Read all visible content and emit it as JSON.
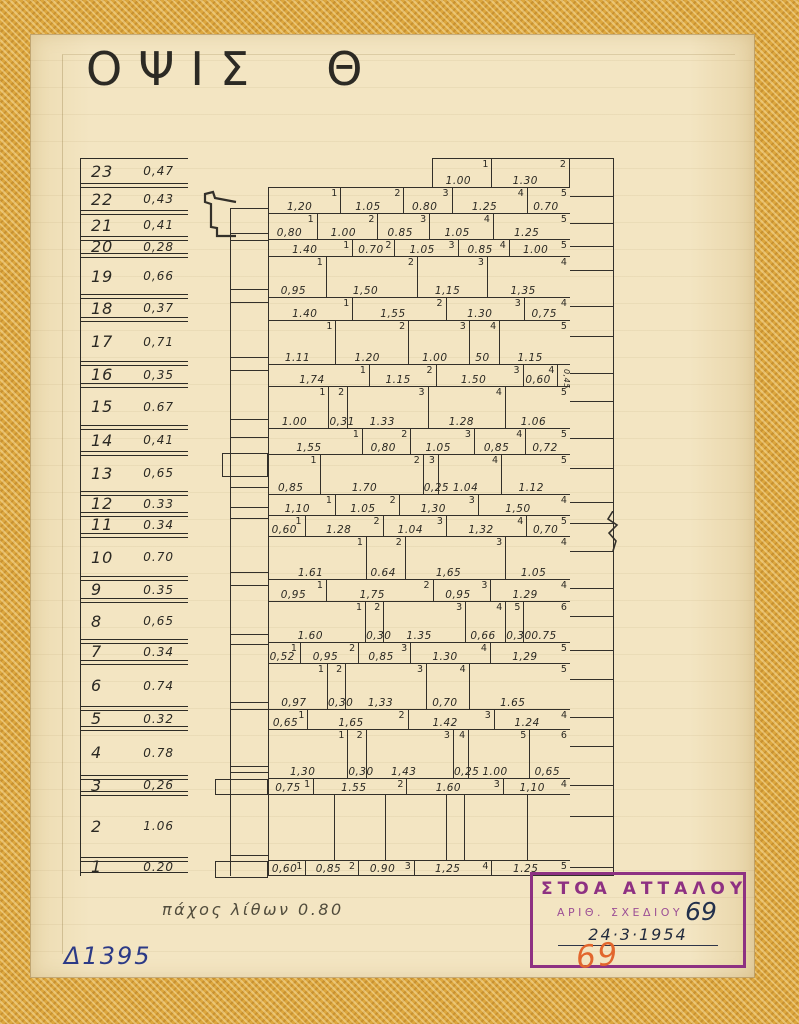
{
  "title": "ΟΨΙΣ  Θ",
  "notes": {
    "thickness": "πάχος λίθων 0.80",
    "ref": "Δ1395"
  },
  "stamp": {
    "line1": "ΣΤΟΑ ΑΤΤΑΛΟΥ",
    "line2": "ΑΡΙΘ. ΣΧΕΔΙΟΥ",
    "number": "69",
    "date": "24·3·1954",
    "number_pencil": "69"
  },
  "colors": {
    "ink": "#33302a",
    "paper": "#f3e5c2",
    "tape": "#dda73e",
    "stamp_purple": "#8e3182",
    "pencil_orange": "#e2662d",
    "ref_blue": "#2c3a86"
  },
  "courses": [
    {
      "n": "23",
      "h": "0,47",
      "offset": 2.75,
      "blocks": [
        {
          "n": "1",
          "v": "1.00",
          "w": 1.0
        },
        {
          "n": "2",
          "v": "1.30",
          "w": 1.3
        }
      ]
    },
    {
      "n": "22",
      "h": "0,43",
      "blocks": [
        {
          "n": "1",
          "v": "1,20",
          "w": 1.2
        },
        {
          "n": "2",
          "v": "1.05",
          "w": 1.05
        },
        {
          "n": "3",
          "v": "0.80",
          "w": 0.8
        },
        {
          "n": "4",
          "v": "1.25",
          "w": 1.25
        },
        {
          "n": "5",
          "v": "0.70",
          "w": 0.7
        }
      ]
    },
    {
      "n": "21",
      "h": "0,41",
      "blocks": [
        {
          "n": "1",
          "v": "0,80",
          "w": 0.8
        },
        {
          "n": "2",
          "v": "1.00",
          "w": 1.0
        },
        {
          "n": "3",
          "v": "0.85",
          "w": 0.85
        },
        {
          "n": "4",
          "v": "1.05",
          "w": 1.05
        },
        {
          "n": "5",
          "v": "1.25",
          "w": 1.25
        }
      ]
    },
    {
      "n": "20",
      "h": "0,28",
      "blocks": [
        {
          "n": "1",
          "v": "1.40",
          "w": 1.4
        },
        {
          "n": "2",
          "v": "0.70",
          "w": 0.7
        },
        {
          "n": "3",
          "v": "1.05",
          "w": 1.05
        },
        {
          "n": "4",
          "v": "0.85",
          "w": 0.85
        },
        {
          "n": "5",
          "v": "1.00",
          "w": 1.0
        }
      ]
    },
    {
      "n": "19",
      "h": "0,66",
      "blocks": [
        {
          "n": "1",
          "v": "0,95",
          "w": 0.95
        },
        {
          "n": "2",
          "v": "1,50",
          "w": 1.5
        },
        {
          "n": "3",
          "v": "1,15",
          "w": 1.15
        },
        {
          "n": "4",
          "v": "1,35",
          "w": 1.35
        }
      ]
    },
    {
      "n": "18",
      "h": "0,37",
      "blocks": [
        {
          "n": "1",
          "v": "1.40",
          "w": 1.4
        },
        {
          "n": "2",
          "v": "1,55",
          "w": 1.55
        },
        {
          "n": "3",
          "v": "1.30",
          "w": 1.3
        },
        {
          "n": "4",
          "v": "0,75",
          "w": 0.75
        }
      ]
    },
    {
      "n": "17",
      "h": "0,71",
      "blocks": [
        {
          "n": "1",
          "v": "1.11",
          "w": 1.11
        },
        {
          "n": "2",
          "v": "1.20",
          "w": 1.2
        },
        {
          "n": "3",
          "v": "1.00",
          "w": 1.0
        },
        {
          "n": "4",
          "v": "50",
          "w": 0.5
        },
        {
          "n": "5",
          "v": "1.15",
          "w": 1.15
        }
      ]
    },
    {
      "n": "16",
      "h": "0,35",
      "blocks": [
        {
          "n": "1",
          "v": "1,74",
          "w": 1.74
        },
        {
          "n": "2",
          "v": "1.15",
          "w": 1.15
        },
        {
          "n": "3",
          "v": "1.50",
          "w": 1.5
        },
        {
          "n": "4",
          "v": "0,60",
          "w": 0.6
        },
        {
          "n": "",
          "v": "0,45",
          "w": 0.2,
          "vertical": true
        }
      ]
    },
    {
      "n": "15",
      "h": "0.67",
      "blocks": [
        {
          "n": "1",
          "v": "1.00",
          "w": 1.0
        },
        {
          "n": "2",
          "v": "0,31",
          "w": 0.31
        },
        {
          "n": "3",
          "v": "1.33",
          "w": 1.33
        },
        {
          "n": "4",
          "v": "1.28",
          "w": 1.28
        },
        {
          "n": "5",
          "v": "1.06",
          "w": 1.06
        }
      ]
    },
    {
      "n": "14",
      "h": "0,41",
      "blocks": [
        {
          "n": "1",
          "v": "1,55",
          "w": 1.55
        },
        {
          "n": "2",
          "v": "0,80",
          "w": 0.8
        },
        {
          "n": "3",
          "v": "1.05",
          "w": 1.05
        },
        {
          "n": "4",
          "v": "0,85",
          "w": 0.85
        },
        {
          "n": "5",
          "v": "0,72",
          "w": 0.72
        }
      ]
    },
    {
      "n": "13",
      "h": "0,65",
      "blocks": [
        {
          "n": "1",
          "v": "0,85",
          "w": 0.85
        },
        {
          "n": "2",
          "v": "1.70",
          "w": 1.7
        },
        {
          "n": "3",
          "v": "0,25",
          "w": 0.25
        },
        {
          "n": "4",
          "v": "1.04",
          "w": 1.04
        },
        {
          "n": "5",
          "v": "1.12",
          "w": 1.12
        }
      ]
    },
    {
      "n": "12",
      "h": "0.33",
      "blocks": [
        {
          "n": "1",
          "v": "1,10",
          "w": 1.1
        },
        {
          "n": "2",
          "v": "1.05",
          "w": 1.05
        },
        {
          "n": "3",
          "v": "1,30",
          "w": 1.3
        },
        {
          "n": "4",
          "v": "1,50",
          "w": 1.5
        }
      ]
    },
    {
      "n": "11",
      "h": "0.34",
      "blocks": [
        {
          "n": "1",
          "v": "0,60",
          "w": 0.6
        },
        {
          "n": "2",
          "v": "1.28",
          "w": 1.28
        },
        {
          "n": "3",
          "v": "1.04",
          "w": 1.04
        },
        {
          "n": "4",
          "v": "1,32",
          "w": 1.32
        },
        {
          "n": "5",
          "v": "0,70",
          "w": 0.7
        }
      ]
    },
    {
      "n": "10",
      "h": "0.70",
      "blocks": [
        {
          "n": "1",
          "v": "1.61",
          "w": 1.61
        },
        {
          "n": "2",
          "v": "0.64",
          "w": 0.64
        },
        {
          "n": "3",
          "v": "1,65",
          "w": 1.65
        },
        {
          "n": "4",
          "v": "1.05",
          "w": 1.05
        }
      ]
    },
    {
      "n": "9",
      "h": "0.35",
      "blocks": [
        {
          "n": "1",
          "v": "0,95",
          "w": 0.95
        },
        {
          "n": "2",
          "v": "1,75",
          "w": 1.75
        },
        {
          "n": "3",
          "v": "0,95",
          "w": 0.95
        },
        {
          "n": "4",
          "v": "1.29",
          "w": 1.29
        }
      ]
    },
    {
      "n": "8",
      "h": "0,65",
      "blocks": [
        {
          "n": "1",
          "v": "1.60",
          "w": 1.6
        },
        {
          "n": "2",
          "v": "0,30",
          "w": 0.3
        },
        {
          "n": "3",
          "v": "1.35",
          "w": 1.35
        },
        {
          "n": "4",
          "v": "0,66",
          "w": 0.66
        },
        {
          "n": "5",
          "v": "0,30",
          "w": 0.3
        },
        {
          "n": "6",
          "v": "0.75",
          "w": 0.75
        }
      ]
    },
    {
      "n": "7",
      "h": "0.34",
      "blocks": [
        {
          "n": "1",
          "v": "0,52",
          "w": 0.52
        },
        {
          "n": "2",
          "v": "0,95",
          "w": 0.95
        },
        {
          "n": "3",
          "v": "0,85",
          "w": 0.85
        },
        {
          "n": "4",
          "v": "1.30",
          "w": 1.3
        },
        {
          "n": "5",
          "v": "1,29",
          "w": 1.29
        }
      ]
    },
    {
      "n": "6",
      "h": "0.74",
      "blocks": [
        {
          "n": "1",
          "v": "0,97",
          "w": 0.97
        },
        {
          "n": "2",
          "v": "0,30",
          "w": 0.3
        },
        {
          "n": "3",
          "v": "1,33",
          "w": 1.33
        },
        {
          "n": "4",
          "v": "0,70",
          "w": 0.7
        },
        {
          "n": "5",
          "v": "1.65",
          "w": 1.65
        }
      ]
    },
    {
      "n": "5",
      "h": "0.32",
      "blocks": [
        {
          "n": "1",
          "v": "0,65",
          "w": 0.65
        },
        {
          "n": "2",
          "v": "1,65",
          "w": 1.65
        },
        {
          "n": "3",
          "v": "1.42",
          "w": 1.42
        },
        {
          "n": "4",
          "v": "1.24",
          "w": 1.24
        }
      ]
    },
    {
      "n": "4",
      "h": "0.78",
      "blocks": [
        {
          "n": "1",
          "v": "1,30",
          "w": 1.3
        },
        {
          "n": "2",
          "v": "0,30",
          "w": 0.3
        },
        {
          "n": "3",
          "v": "1,43",
          "w": 1.43
        },
        {
          "n": "4",
          "v": "0,25",
          "w": 0.25
        },
        {
          "n": "5",
          "v": "1.00",
          "w": 1.0
        },
        {
          "n": "6",
          "v": "0,65",
          "w": 0.65
        }
      ]
    },
    {
      "n": "3",
      "h": "0,26",
      "blocks": [
        {
          "n": "1",
          "v": "0,75",
          "w": 0.75
        },
        {
          "n": "2",
          "v": "1.55",
          "w": 1.55
        },
        {
          "n": "3",
          "v": "1.60",
          "w": 1.6
        },
        {
          "n": "4",
          "v": "1,10",
          "w": 1.1
        }
      ]
    },
    {
      "n": "2",
      "h": "1.06",
      "blocks": [
        {
          "n": "",
          "v": "",
          "w": 1.1
        },
        {
          "n": "",
          "v": "",
          "w": 0.85
        },
        {
          "n": "",
          "v": "",
          "w": 1.0
        },
        {
          "n": "",
          "v": "",
          "w": 0.3
        },
        {
          "n": "",
          "v": "",
          "w": 1.05
        },
        {
          "n": "",
          "v": "",
          "w": 0.7
        }
      ]
    },
    {
      "n": "1",
      "h": "0.20",
      "blocks": [
        {
          "n": "1",
          "v": "0,60",
          "w": 0.6
        },
        {
          "n": "2",
          "v": "0,85",
          "w": 0.85
        },
        {
          "n": "3",
          "v": "0.90",
          "w": 0.9
        },
        {
          "n": "4",
          "v": "1,25",
          "w": 1.25
        },
        {
          "n": "5",
          "v": "1.25",
          "w": 1.25
        }
      ]
    }
  ]
}
